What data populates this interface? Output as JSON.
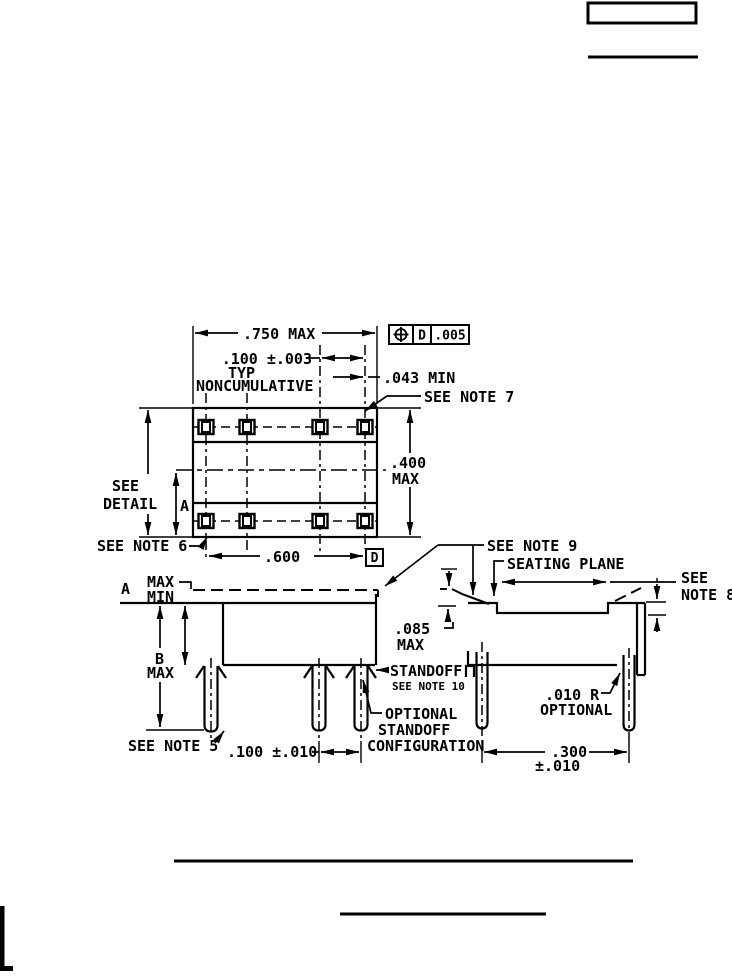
{
  "page": {
    "background": "#ffffff",
    "line_color": "#000000"
  },
  "top_view": {
    "dim_width": ".750 MAX",
    "fcf": {
      "symbol": "position-tolerance",
      "datum": "D",
      "tolerance": ".005"
    },
    "dim_pitch": ".100 ±.003",
    "dim_pitch_note1": "TYP",
    "dim_pitch_note2": "NONCUMULATIVE",
    "dim_lead": ".043 MIN",
    "note7": "SEE NOTE 7",
    "dim_depth": ".400",
    "dim_depth_suffix": "MAX",
    "detail_see": "SEE",
    "detail_word": "DETAIL",
    "detail_letter": "A",
    "note6": "SEE NOTE 6",
    "dim_span": ".600",
    "datum": "D"
  },
  "side_view": {
    "note9": "SEE NOTE 9",
    "seating_plane": "SEATING PLANE",
    "note8_line1": "SEE",
    "note8_line2": "NOTE 8",
    "dim_a": "A",
    "dim_a_max": "MAX",
    "dim_a_min": "MIN",
    "dim_b": "B",
    "dim_b_max": "MAX",
    "dim_standoff_height": ".085",
    "dim_standoff_height_suffix": "MAX",
    "standoff": "STANDOFF",
    "note10": "SEE NOTE 10",
    "optional_line1": "OPTIONAL",
    "optional_line2": "STANDOFF",
    "optional_line3": "CONFIGURATION",
    "note5": "SEE NOTE 5",
    "dim_lead_pitch": ".100 ±.010",
    "radius_line1": ".010 R",
    "radius_line2": "OPTIONAL",
    "dim_row": ".300",
    "dim_row_tol": "±.010"
  }
}
